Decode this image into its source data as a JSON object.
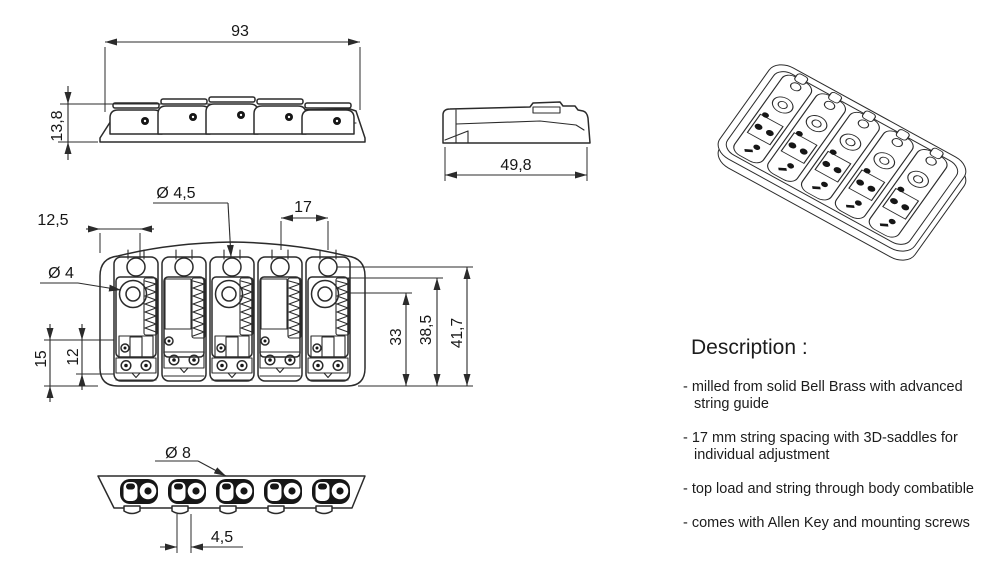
{
  "drawing": {
    "title": "bass bridge technical drawing",
    "front_view": {
      "width": "93",
      "height": "13,8"
    },
    "side_view": {
      "depth": "49,8"
    },
    "top_view": {
      "edge_to_hole": "12,5",
      "string_hole_dia": "Ø 4,5",
      "screw_dia": "Ø 4",
      "string_spacing": "17",
      "saddle_h1": "15",
      "saddle_h2": "12",
      "depth_to_screw": "33",
      "depth_to_saddle": "38,5",
      "total_depth": "41,7"
    },
    "bottom_view": {
      "string_hole_dia": "Ø 8",
      "hole_offset": "4,5"
    }
  },
  "description": {
    "title": "Description :",
    "bullets": [
      "- milled from solid Bell Brass with advanced string guide",
      "- 17 mm string spacing with 3D-saddles for individual adjustment",
      "- top load and string through body combatible",
      "- comes with Allen Key and mounting screws"
    ]
  }
}
